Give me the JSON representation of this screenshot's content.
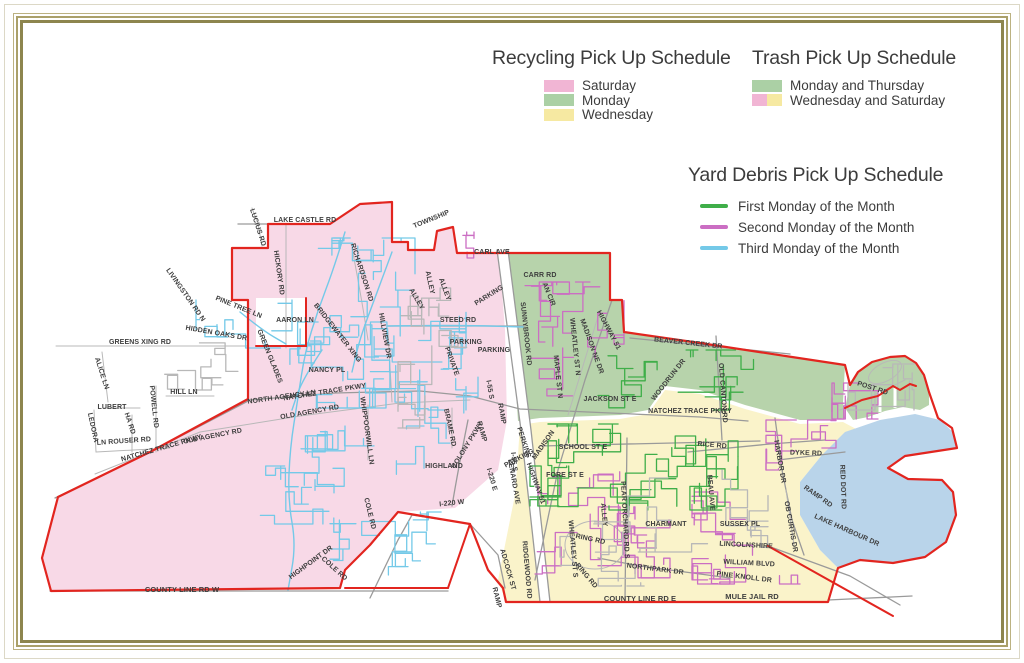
{
  "colors": {
    "frame_gold": "#8d854e",
    "title_text": "#3c3c3c",
    "label_text": "#3e3e3e",
    "boundary_red": "#e2251f",
    "road_gray": "#9a9a9a",
    "road_gray_light": "#b8b8b8",
    "legend_pink": "#f1b5d4",
    "legend_green": "#abd0a5",
    "legend_yellow": "#f6e9a2",
    "region_pink": "#f8d9e7",
    "region_green": "#b7d3ab",
    "region_yellow": "#faf3ca",
    "lake_blue": "#b9d4ea",
    "route_green": "#3fae49",
    "route_magenta": "#cb6ec3",
    "route_blue": "#74c9e8"
  },
  "legends": {
    "recycling": {
      "title": "Recycling Pick Up Schedule",
      "items": [
        {
          "label": "Saturday",
          "swatches": [
            "legend_pink"
          ]
        },
        {
          "label": "Monday",
          "swatches": [
            "legend_green"
          ]
        },
        {
          "label": "Wednesday",
          "swatches": [
            "legend_yellow"
          ]
        }
      ]
    },
    "trash": {
      "title": "Trash Pick Up Schedule",
      "items": [
        {
          "label": "Monday and Thursday",
          "swatches": [
            "legend_green"
          ]
        },
        {
          "label": "Wednesday and Saturday",
          "swatches": [
            "legend_pink",
            "legend_yellow"
          ]
        }
      ]
    },
    "yard_debris": {
      "title": "Yard Debris Pick Up Schedule",
      "items": [
        {
          "label": "First Monday of the Month",
          "line": "route_green"
        },
        {
          "label": "Second Monday of the Month",
          "line": "route_magenta"
        },
        {
          "label": "Third Monday of the Month",
          "line": "route_blue"
        }
      ]
    }
  },
  "map": {
    "road_labels": [
      {
        "t": "LUCIUS RD",
        "x": 256,
        "y": 228,
        "r": 72
      },
      {
        "t": "LAKE CASTLE RD",
        "x": 305,
        "y": 222,
        "r": 0
      },
      {
        "t": "TOWNSHIP",
        "x": 432,
        "y": 221,
        "r": -22
      },
      {
        "t": "HICKORY RD",
        "x": 277,
        "y": 273,
        "r": 82
      },
      {
        "t": "LIVINGSTON RD N",
        "x": 184,
        "y": 296,
        "r": 55
      },
      {
        "t": "PINE TREE LN",
        "x": 238,
        "y": 309,
        "r": 22
      },
      {
        "t": "AARON LN",
        "x": 295,
        "y": 322,
        "r": 0
      },
      {
        "t": "HIDDEN OAKS DR",
        "x": 216,
        "y": 335,
        "r": 10
      },
      {
        "t": "GREENS XING RD",
        "x": 140,
        "y": 344,
        "r": 0
      },
      {
        "t": "RICHARDSON RD",
        "x": 360,
        "y": 273,
        "r": 72
      },
      {
        "t": "BRIDGEWATER XING",
        "x": 336,
        "y": 334,
        "r": 52
      },
      {
        "t": "HILLVIEW DR",
        "x": 383,
        "y": 336,
        "r": 80
      },
      {
        "t": "GREEN GLADES",
        "x": 268,
        "y": 357,
        "r": 68
      },
      {
        "t": "NANCY PL",
        "x": 327,
        "y": 372,
        "r": 0
      },
      {
        "t": "ALICE LN",
        "x": 100,
        "y": 374,
        "r": 72
      },
      {
        "t": "HILL LN",
        "x": 184,
        "y": 394,
        "r": 0
      },
      {
        "t": "LUBERT",
        "x": 112,
        "y": 409,
        "r": 0
      },
      {
        "t": "POWELL RD",
        "x": 152,
        "y": 407,
        "r": 84
      },
      {
        "t": "LEDORA",
        "x": 91,
        "y": 428,
        "r": 78
      },
      {
        "t": "HA RD",
        "x": 128,
        "y": 424,
        "r": 72
      },
      {
        "t": "LN ROUSER RD",
        "x": 124,
        "y": 443,
        "r": -4
      },
      {
        "t": "NORTH AGENCY LN",
        "x": 282,
        "y": 399,
        "r": -8
      },
      {
        "t": "NATCHEZ TRACE PKWY",
        "x": 325,
        "y": 394,
        "r": -9
      },
      {
        "t": "OLD AGENCY RD",
        "x": 310,
        "y": 414,
        "r": -10
      },
      {
        "t": "NATCHEZ TRACE PKWY",
        "x": 162,
        "y": 450,
        "r": -16
      },
      {
        "t": "OLD AGENCY RD",
        "x": 213,
        "y": 438,
        "r": -11
      },
      {
        "t": "WHIPPOORWILL LN",
        "x": 365,
        "y": 431,
        "r": 82
      },
      {
        "t": "BRAME RD",
        "x": 448,
        "y": 428,
        "r": 78
      },
      {
        "t": "HIGHLAND",
        "x": 444,
        "y": 468,
        "r": 0
      },
      {
        "t": "COLONY PKWY",
        "x": 469,
        "y": 446,
        "r": -58
      },
      {
        "t": "COLE RD",
        "x": 368,
        "y": 514,
        "r": 76
      },
      {
        "t": "HIGHPOINT DR",
        "x": 312,
        "y": 564,
        "r": -36
      },
      {
        "t": "COLE RD",
        "x": 333,
        "y": 570,
        "r": 42
      },
      {
        "t": "I-220 W",
        "x": 452,
        "y": 505,
        "r": -6
      },
      {
        "t": "I-220 E",
        "x": 490,
        "y": 480,
        "r": 74
      },
      {
        "t": "COUNTY LINE RD W",
        "x": 182,
        "y": 592,
        "r": 0,
        "s": 7.5
      },
      {
        "t": "STEED RD",
        "x": 458,
        "y": 322,
        "r": 0
      },
      {
        "t": "ALLEY",
        "x": 428,
        "y": 283,
        "r": 78
      },
      {
        "t": "ALLEY",
        "x": 443,
        "y": 290,
        "r": 70
      },
      {
        "t": "ALLEY",
        "x": 415,
        "y": 300,
        "r": 60
      },
      {
        "t": "PARKING",
        "x": 490,
        "y": 297,
        "r": -32
      },
      {
        "t": "PARKING",
        "x": 466,
        "y": 344,
        "r": 0
      },
      {
        "t": "PARKING",
        "x": 494,
        "y": 352,
        "r": 0
      },
      {
        "t": "PRIVATE",
        "x": 450,
        "y": 362,
        "r": 70
      },
      {
        "t": "RAMP",
        "x": 480,
        "y": 432,
        "r": 74
      },
      {
        "t": "RAMP",
        "x": 500,
        "y": 414,
        "r": 80
      },
      {
        "t": "RAMP",
        "x": 495,
        "y": 598,
        "r": 76
      },
      {
        "t": "I-55 S",
        "x": 488,
        "y": 390,
        "r": 80
      },
      {
        "t": "I-55 S",
        "x": 512,
        "y": 462,
        "r": 84
      },
      {
        "t": "CARL AVE",
        "x": 492,
        "y": 254,
        "r": 0
      },
      {
        "t": "CARR RD",
        "x": 540,
        "y": 277,
        "r": 0
      },
      {
        "t": "AN CIR",
        "x": 547,
        "y": 295,
        "r": 68
      },
      {
        "t": "SUNNYBROOK RD",
        "x": 524,
        "y": 334,
        "r": 84
      },
      {
        "t": "WHEATLEY ST N",
        "x": 573,
        "y": 347,
        "r": 84
      },
      {
        "t": "MAPLE ST N",
        "x": 556,
        "y": 377,
        "r": 84
      },
      {
        "t": "MADISON NE DR",
        "x": 590,
        "y": 347,
        "r": 70
      },
      {
        "t": "HIGHWAY 51",
        "x": 607,
        "y": 331,
        "r": 62
      },
      {
        "t": "JACKSON ST E",
        "x": 610,
        "y": 401,
        "r": 0
      },
      {
        "t": "BEAVER CREEK DR",
        "x": 688,
        "y": 345,
        "r": 6
      },
      {
        "t": "WOODRUN DR",
        "x": 670,
        "y": 381,
        "r": -52
      },
      {
        "t": "NATCHEZ TRACE PKWY",
        "x": 690,
        "y": 413,
        "r": 0
      },
      {
        "t": "OLD CANTON RD",
        "x": 721,
        "y": 393,
        "r": 86
      },
      {
        "t": "SCHOOL ST E",
        "x": 583,
        "y": 449,
        "r": 0
      },
      {
        "t": "FORE ST E",
        "x": 565,
        "y": 477,
        "r": 0
      },
      {
        "t": "PERKINS",
        "x": 522,
        "y": 443,
        "r": 72
      },
      {
        "t": "MADISON",
        "x": 545,
        "y": 446,
        "r": -55
      },
      {
        "t": "PARKING",
        "x": 520,
        "y": 460,
        "r": -28
      },
      {
        "t": "LENARD AVE",
        "x": 512,
        "y": 482,
        "r": 80
      },
      {
        "t": "HIGHWAY 51",
        "x": 534,
        "y": 484,
        "r": 70
      },
      {
        "t": "RIDGEWOOD RD",
        "x": 525,
        "y": 570,
        "r": 85
      },
      {
        "t": "ADCOCK ST",
        "x": 506,
        "y": 570,
        "r": 74
      },
      {
        "t": "WHEATLEY ST S",
        "x": 571,
        "y": 549,
        "r": 85
      },
      {
        "t": "ALLEY",
        "x": 602,
        "y": 515,
        "r": 85
      },
      {
        "t": "PEAR ORCHARD RD S",
        "x": 623,
        "y": 520,
        "r": 87
      },
      {
        "t": "BEAU AVE",
        "x": 709,
        "y": 493,
        "r": 85
      },
      {
        "t": "CHARMANT",
        "x": 666,
        "y": 526,
        "r": 0
      },
      {
        "t": "SUSSEX PL",
        "x": 740,
        "y": 526,
        "r": 0
      },
      {
        "t": "LINCOLNSHIRE",
        "x": 746,
        "y": 547,
        "r": 3
      },
      {
        "t": "WILLIAM BLVD",
        "x": 749,
        "y": 565,
        "r": 3
      },
      {
        "t": "PINE KNOLL DR",
        "x": 744,
        "y": 579,
        "r": 7
      },
      {
        "t": "RING RD",
        "x": 590,
        "y": 541,
        "r": 12
      },
      {
        "t": "RING RD",
        "x": 585,
        "y": 577,
        "r": 50
      },
      {
        "t": "NORTHPARK DR",
        "x": 655,
        "y": 571,
        "r": 7
      },
      {
        "t": "COUNTY LINE RD E",
        "x": 640,
        "y": 601,
        "r": 0,
        "s": 7.5
      },
      {
        "t": "MULE JAIL RD",
        "x": 752,
        "y": 599,
        "r": 0,
        "s": 7.5
      },
      {
        "t": "RICE RD",
        "x": 712,
        "y": 447,
        "r": 5
      },
      {
        "t": "HARBOR DR",
        "x": 778,
        "y": 462,
        "r": 80
      },
      {
        "t": "OB CURTIS DR",
        "x": 789,
        "y": 527,
        "r": 80
      },
      {
        "t": "DYKE RD",
        "x": 806,
        "y": 455,
        "r": 2
      },
      {
        "t": "RED DOT RD",
        "x": 841,
        "y": 487,
        "r": 88
      },
      {
        "t": "RAMP RD",
        "x": 817,
        "y": 498,
        "r": 35
      },
      {
        "t": "LAKE HARBOUR DR",
        "x": 846,
        "y": 532,
        "r": 24
      },
      {
        "t": "POST RD",
        "x": 872,
        "y": 390,
        "r": 18
      }
    ],
    "route_clusters": [
      {
        "x": 300,
        "y": 238,
        "w": 115,
        "h": 98,
        "n": 7,
        "c": "route_blue"
      },
      {
        "x": 252,
        "y": 322,
        "w": 168,
        "h": 86,
        "n": 9,
        "c": "route_blue"
      },
      {
        "x": 358,
        "y": 298,
        "w": 108,
        "h": 112,
        "n": 8,
        "c": "route_blue"
      },
      {
        "x": 296,
        "y": 426,
        "w": 128,
        "h": 86,
        "n": 7,
        "c": "route_blue"
      },
      {
        "x": 330,
        "y": 512,
        "w": 118,
        "h": 66,
        "n": 6,
        "c": "route_blue"
      },
      {
        "x": 256,
        "y": 466,
        "w": 78,
        "h": 58,
        "n": 4,
        "c": "route_blue"
      },
      {
        "x": 196,
        "y": 300,
        "w": 96,
        "h": 48,
        "n": 4,
        "c": "route_blue"
      },
      {
        "x": 418,
        "y": 370,
        "w": 60,
        "h": 90,
        "n": 4,
        "c": "route_blue"
      },
      {
        "x": 512,
        "y": 282,
        "w": 112,
        "h": 122,
        "n": 9,
        "c": "route_magenta"
      },
      {
        "x": 448,
        "y": 232,
        "w": 26,
        "h": 26,
        "n": 2,
        "c": "route_magenta"
      },
      {
        "x": 535,
        "y": 462,
        "w": 100,
        "h": 112,
        "n": 8,
        "c": "route_magenta"
      },
      {
        "x": 598,
        "y": 520,
        "w": 72,
        "h": 58,
        "n": 4,
        "c": "route_magenta"
      },
      {
        "x": 692,
        "y": 492,
        "w": 108,
        "h": 92,
        "n": 8,
        "c": "route_magenta"
      },
      {
        "x": 766,
        "y": 420,
        "w": 70,
        "h": 50,
        "n": 5,
        "c": "route_magenta"
      },
      {
        "x": 832,
        "y": 383,
        "w": 46,
        "h": 36,
        "n": 4,
        "c": "route_magenta"
      },
      {
        "x": 598,
        "y": 350,
        "w": 162,
        "h": 60,
        "n": 7,
        "c": "route_green"
      },
      {
        "x": 548,
        "y": 424,
        "w": 178,
        "h": 86,
        "n": 10,
        "c": "route_green"
      },
      {
        "x": 620,
        "y": 436,
        "w": 118,
        "h": 72,
        "n": 6,
        "c": "route_green"
      },
      {
        "x": 530,
        "y": 466,
        "w": 40,
        "h": 40,
        "n": 3,
        "c": "route_green"
      },
      {
        "x": 398,
        "y": 288,
        "w": 78,
        "h": 140,
        "n": 8,
        "c": "road_gray_light"
      },
      {
        "x": 628,
        "y": 452,
        "w": 140,
        "h": 100,
        "n": 6,
        "c": "road_gray_light"
      },
      {
        "x": 560,
        "y": 520,
        "w": 108,
        "h": 66,
        "n": 5,
        "c": "road_gray_light"
      },
      {
        "x": 848,
        "y": 364,
        "w": 66,
        "h": 46,
        "n": 4,
        "c": "road_gray_light"
      },
      {
        "x": 120,
        "y": 300,
        "w": 120,
        "h": 90,
        "n": 4,
        "c": "road_gray_light"
      }
    ],
    "creeks": [
      {
        "c": "route_blue",
        "pts": [
          [
            345,
            232
          ],
          [
            334,
            268
          ],
          [
            318,
            310
          ],
          [
            305,
            352
          ],
          [
            298,
            398
          ],
          [
            290,
            448
          ],
          [
            288,
            500
          ],
          [
            296,
            545
          ],
          [
            288,
            590
          ]
        ]
      },
      {
        "c": "route_blue",
        "pts": [
          [
            392,
            252
          ],
          [
            375,
            298
          ],
          [
            360,
            338
          ],
          [
            352,
            372
          ]
        ]
      },
      {
        "c": "route_blue",
        "pts": [
          [
            240,
            312
          ],
          [
            262,
            330
          ],
          [
            286,
            344
          ]
        ]
      },
      {
        "c": "route_blue",
        "pts": [
          [
            322,
            350
          ],
          [
            302,
            380
          ],
          [
            292,
            410
          ]
        ]
      },
      {
        "c": "route_blue",
        "pts": [
          [
            388,
            326
          ],
          [
            455,
            325
          ],
          [
            523,
            327
          ]
        ]
      }
    ]
  }
}
